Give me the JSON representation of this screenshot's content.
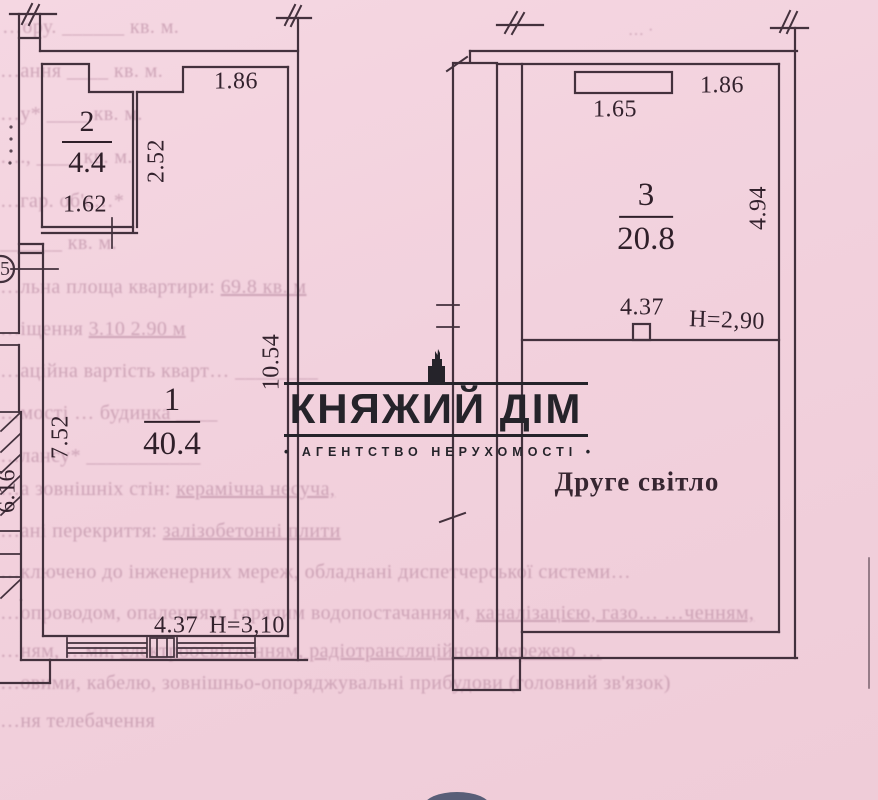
{
  "colors": {
    "paper": "#f2d1dd",
    "ink": "#43313d",
    "faded_ink": "#b4849c",
    "watermark": "#25232a",
    "stamp": "#3e4a66"
  },
  "watermark": {
    "title": "КНЯЖИЙ ДІМ",
    "subtitle": "• АГЕНТСТВО НЕРУХОМОСТІ •"
  },
  "left_plan": {
    "room_upper": {
      "number": "2",
      "area": "4.4"
    },
    "room_main": {
      "number": "1",
      "area": "40.4"
    },
    "dims": {
      "top_width": "1.86",
      "upper_room_width": "1.62",
      "upper_room_depth": "2.52",
      "right_height": "10.54",
      "left_height": "7.52",
      "outer_left_height": "6.16",
      "bottom_width": "4.37",
      "ceiling_height": "H=3,10"
    },
    "callout_bubble": "5"
  },
  "right_plan": {
    "room": {
      "number": "3",
      "area": "20.8"
    },
    "dims": {
      "top_width": "1.86",
      "shaft_width": "1.65",
      "right_height": "4.94",
      "mid_width": "4.37",
      "ceiling_height": "H=2,90"
    },
    "annotation": "Друге світло"
  },
  "faded_text": {
    "lines": [
      {
        "a": "…ору.  ______ кв. м.",
        "b": ""
      },
      {
        "a": "…ання  ____ кв. м.",
        "b": ""
      },
      {
        "a": "…у*  ____ кв. м.",
        "b": ""
      },
      {
        "a": "….,  ____ кв. м.",
        "b": ""
      },
      {
        "a": "…гар. об'є…*",
        "b": ""
      },
      {
        "a": "______ кв. м.",
        "b": ""
      },
      {
        "a": "…льна площа квартири:  ",
        "b": "69.8 кв. м"
      },
      {
        "a": "…іщення  ",
        "b": "3.10 2.90 м"
      },
      {
        "a": "…аційна вартість кварт…  ________",
        "b": ""
      },
      {
        "a": "…мості  … будинка  ____",
        "b": ""
      },
      {
        "a": "…лансу*  ___________",
        "b": ""
      },
      {
        "a": "…а зовнішніх стін:  ",
        "b": "керамічна несуча,"
      },
      {
        "a": "…ані перекриття:  ",
        "b": "залізобетонні плити"
      },
      {
        "a": "…ключено до інженерних мереж, обладнані диспетчерської системи…",
        "b": ""
      },
      {
        "a": "…опроводом, опаленням, гарячим водопостачанням,  ",
        "b": "каналізацією,  газо…  …ченням,"
      },
      {
        "a": "…ням,  …ми,  ",
        "b": "електроосвітленням, радіотрансляційною мережею …"
      },
      {
        "a": "…овими, кабелю, зовнішньо-опоряджувальні прибудови (головний зв'язок)",
        "b": ""
      },
      {
        "a": "…ня телебачення",
        "b": ""
      },
      {
        "a": "… ∙",
        "b": ""
      }
    ]
  }
}
